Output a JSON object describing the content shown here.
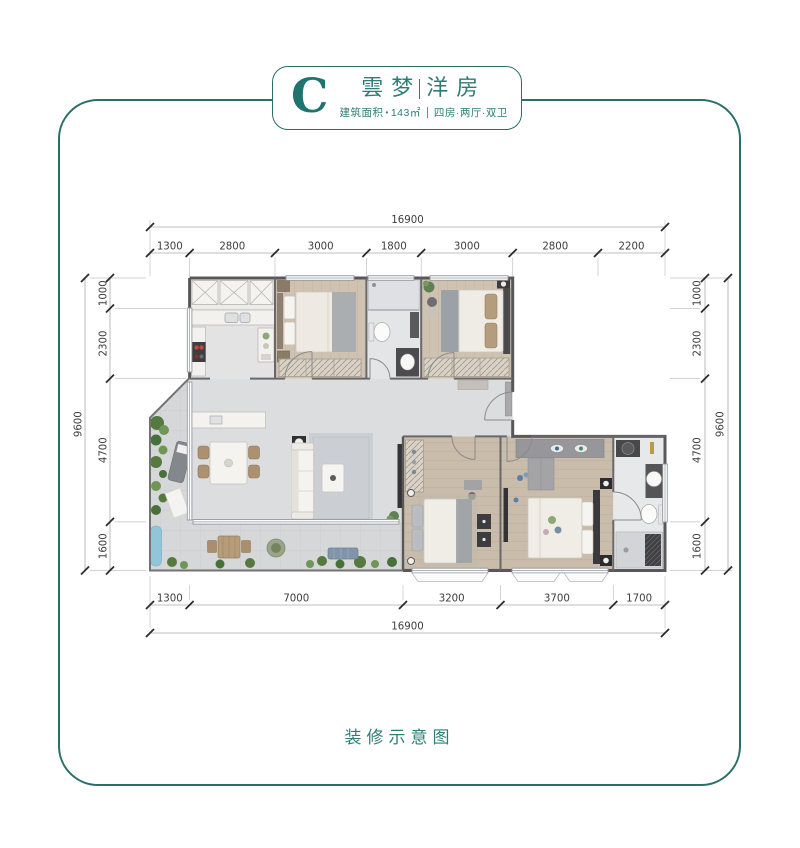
{
  "header": {
    "badge_letter": "C",
    "project_left": "雲梦",
    "project_right": "洋房",
    "area_label": "建筑面积",
    "area_dot": "•",
    "area_value": "143㎡",
    "layout_value": "四房·两厅·双卫"
  },
  "plan": {
    "dims": {
      "top": {
        "total": "16900",
        "segments": [
          "1300",
          "2800",
          "3000",
          "1800",
          "3000",
          "2800",
          "2200"
        ]
      },
      "bottom": {
        "total": "16900",
        "segments": [
          "1300",
          "7000",
          "3200",
          "3700",
          "1700"
        ]
      },
      "left": {
        "total": "9600",
        "segments": [
          "1000",
          "2300",
          "4700",
          "1600"
        ]
      },
      "right": {
        "total": "9600",
        "segments": [
          "1000",
          "2300",
          "4700",
          "1600"
        ]
      }
    }
  },
  "footer": {
    "caption": "装修示意图"
  },
  "colors": {
    "accent": "#2e7d75",
    "frame": "#2c6e68",
    "wall": "#58585a",
    "wood": "#cfc2b1"
  }
}
